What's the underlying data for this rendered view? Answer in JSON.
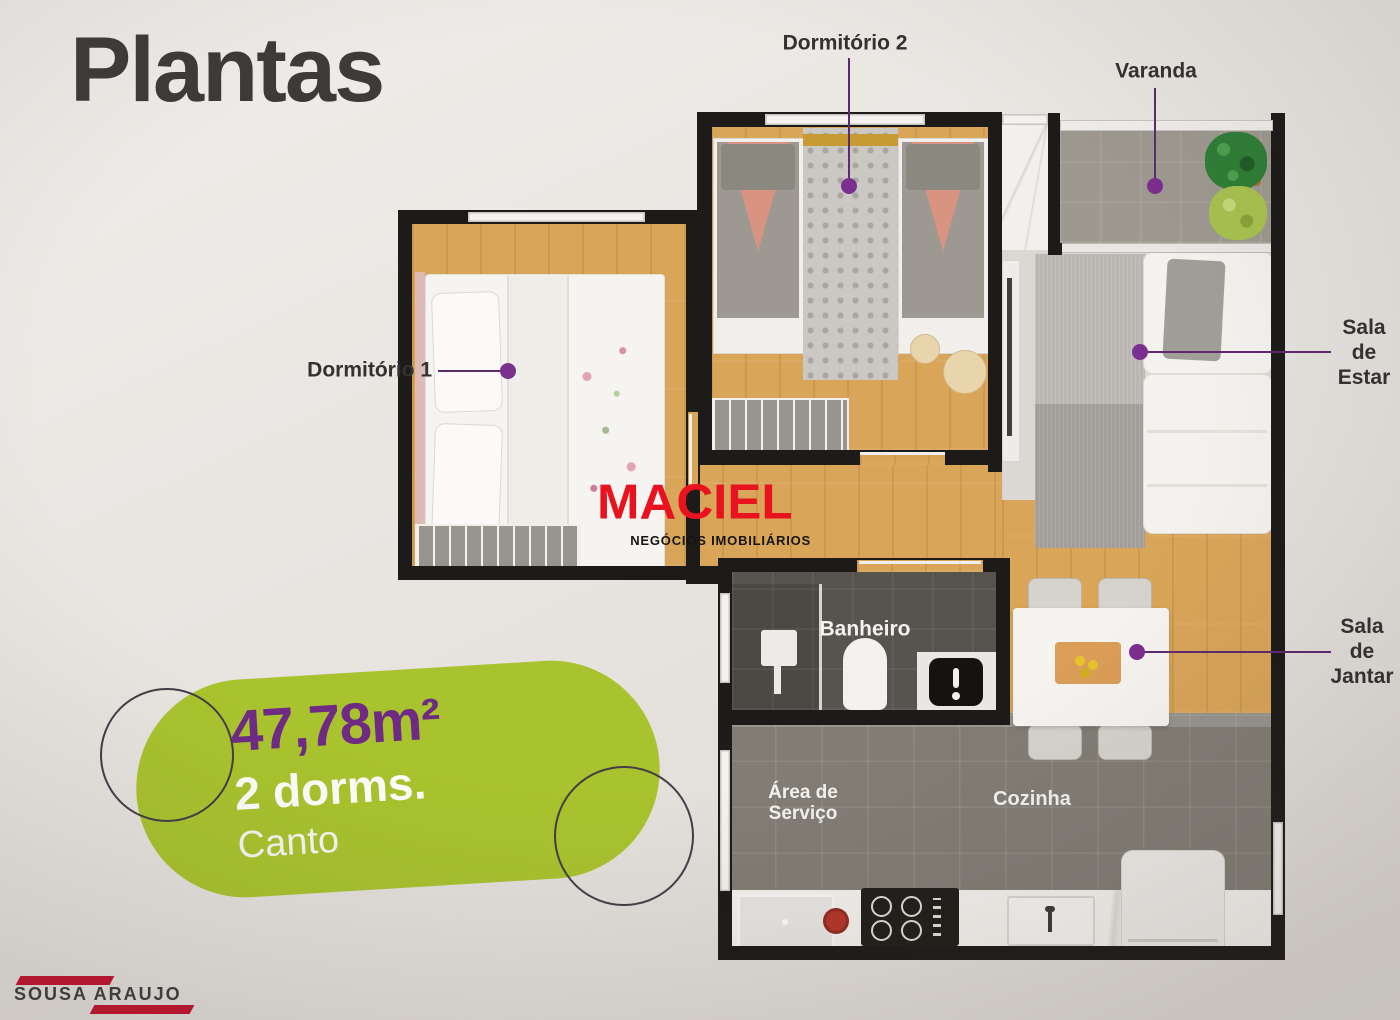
{
  "page": {
    "title": "Plantas"
  },
  "plan": {
    "callouts": {
      "dormitorio2": "Dormitório 2",
      "varanda": "Varanda",
      "dormitorio1": "Dormitório 1",
      "sala_estar_l1": "Sala de",
      "sala_estar_l2": "Estar",
      "sala_jantar_l1": "Sala de",
      "sala_jantar_l2": "Jantar"
    },
    "rooms": {
      "banheiro": "Banheiro",
      "area_servico_l1": "Área de",
      "area_servico_l2": "Serviço",
      "cozinha": "Cozinha"
    }
  },
  "info_badge": {
    "area": "47,78m²",
    "bedrooms": "2 dorms.",
    "layout": "Canto"
  },
  "watermark": {
    "brand": "MACIEL",
    "tagline": "NEGÓCIOS IMOBILIÁRIOS"
  },
  "footer": {
    "brand": "SOUSA ARAUJO"
  },
  "colors": {
    "callout_accent": "#7b2f8e",
    "leader_line": "#5e2a6e",
    "badge_green": "#a9c32e",
    "badge_area_purple": "#6f2b84",
    "brand_red": "#e8131f",
    "footer_red": "#c3142f",
    "wall": "#1d1b19",
    "wood_floor": "#d9a558",
    "title_text": "#3d3b3a"
  }
}
